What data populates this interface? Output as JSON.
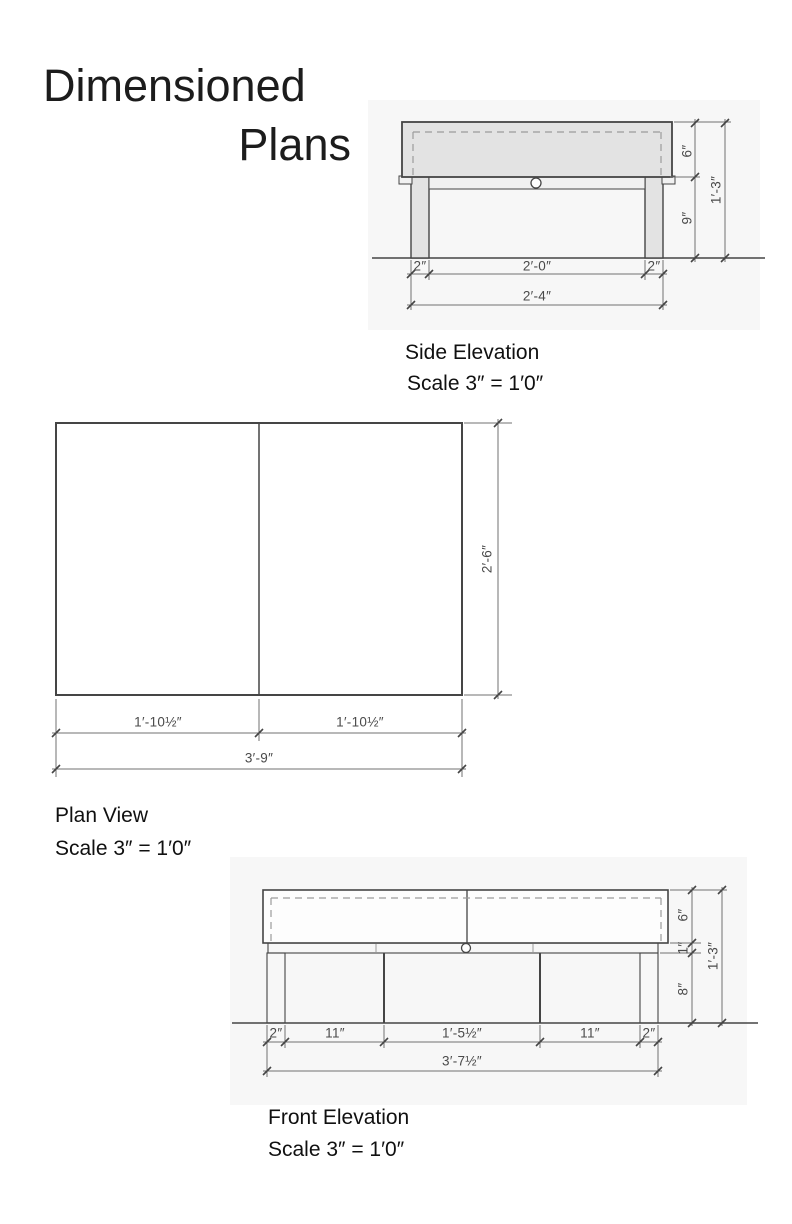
{
  "page": {
    "title_line1": "Dimensioned",
    "title_line2": "Plans"
  },
  "colors": {
    "panel": "#f7f7f7",
    "line": "#454545",
    "fill_light": "#e3e3e3",
    "dimline": "#707070",
    "dash": "#9b9b9b",
    "dim_text": "#4a4a4a"
  },
  "side_elevation": {
    "label": "Side Elevation",
    "scale": "Scale 3″ = 1′0″",
    "dims": {
      "top_height": "6″",
      "leg_height": "9″",
      "total_height": "1′-3″",
      "left_leg": "2″",
      "span": "2′-0″",
      "right_leg": "2″",
      "total_width": "2′-4″"
    }
  },
  "plan_view": {
    "label": "Plan View",
    "scale": "Scale 3″ = 1′0″",
    "dims": {
      "depth": "2′-6″",
      "left_half": "1′-10½″",
      "right_half": "1′-10½″",
      "total_width": "3′-9″"
    }
  },
  "front_elevation": {
    "label": "Front Elevation",
    "scale": "Scale 3″ = 1′0″",
    "dims": {
      "top_height": "6″",
      "apron_height": "1″",
      "leg_height": "8″",
      "total_height": "1′-3″",
      "left_leg": "2″",
      "left_bay": "11″",
      "center_bay": "1′-5½″",
      "right_bay": "11″",
      "right_leg": "2″",
      "total_width": "3′-7½″"
    }
  }
}
